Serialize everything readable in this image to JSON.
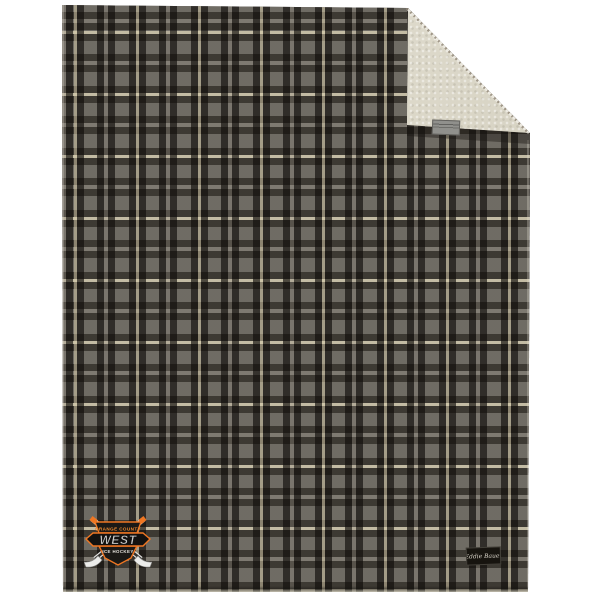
{
  "scene": {
    "description_label": "plaid-blanket-product-photo",
    "background_color": "#ffffff"
  },
  "blanket": {
    "plaid_colors": {
      "field_gray": "#6f6b64",
      "dark_band": "#312d27",
      "cream_stripe": "#d8d0b4",
      "light_gray_center": "#827d74"
    },
    "sherpa_color": "#dcd8ca",
    "fold_tag_color": "#90908c"
  },
  "logo": {
    "top_text": "ORANGE COUNTY",
    "team_name": "WEST",
    "bottom_text": "ICE HOCKEY",
    "accent_color": "#ef7622",
    "letter_color": "#cbcbc9",
    "icon": "crossed-hockey-sticks"
  },
  "brand_label": {
    "text": "Eddie Bauer",
    "bg_color": "#17140f",
    "text_color": "#d8d3c8"
  }
}
